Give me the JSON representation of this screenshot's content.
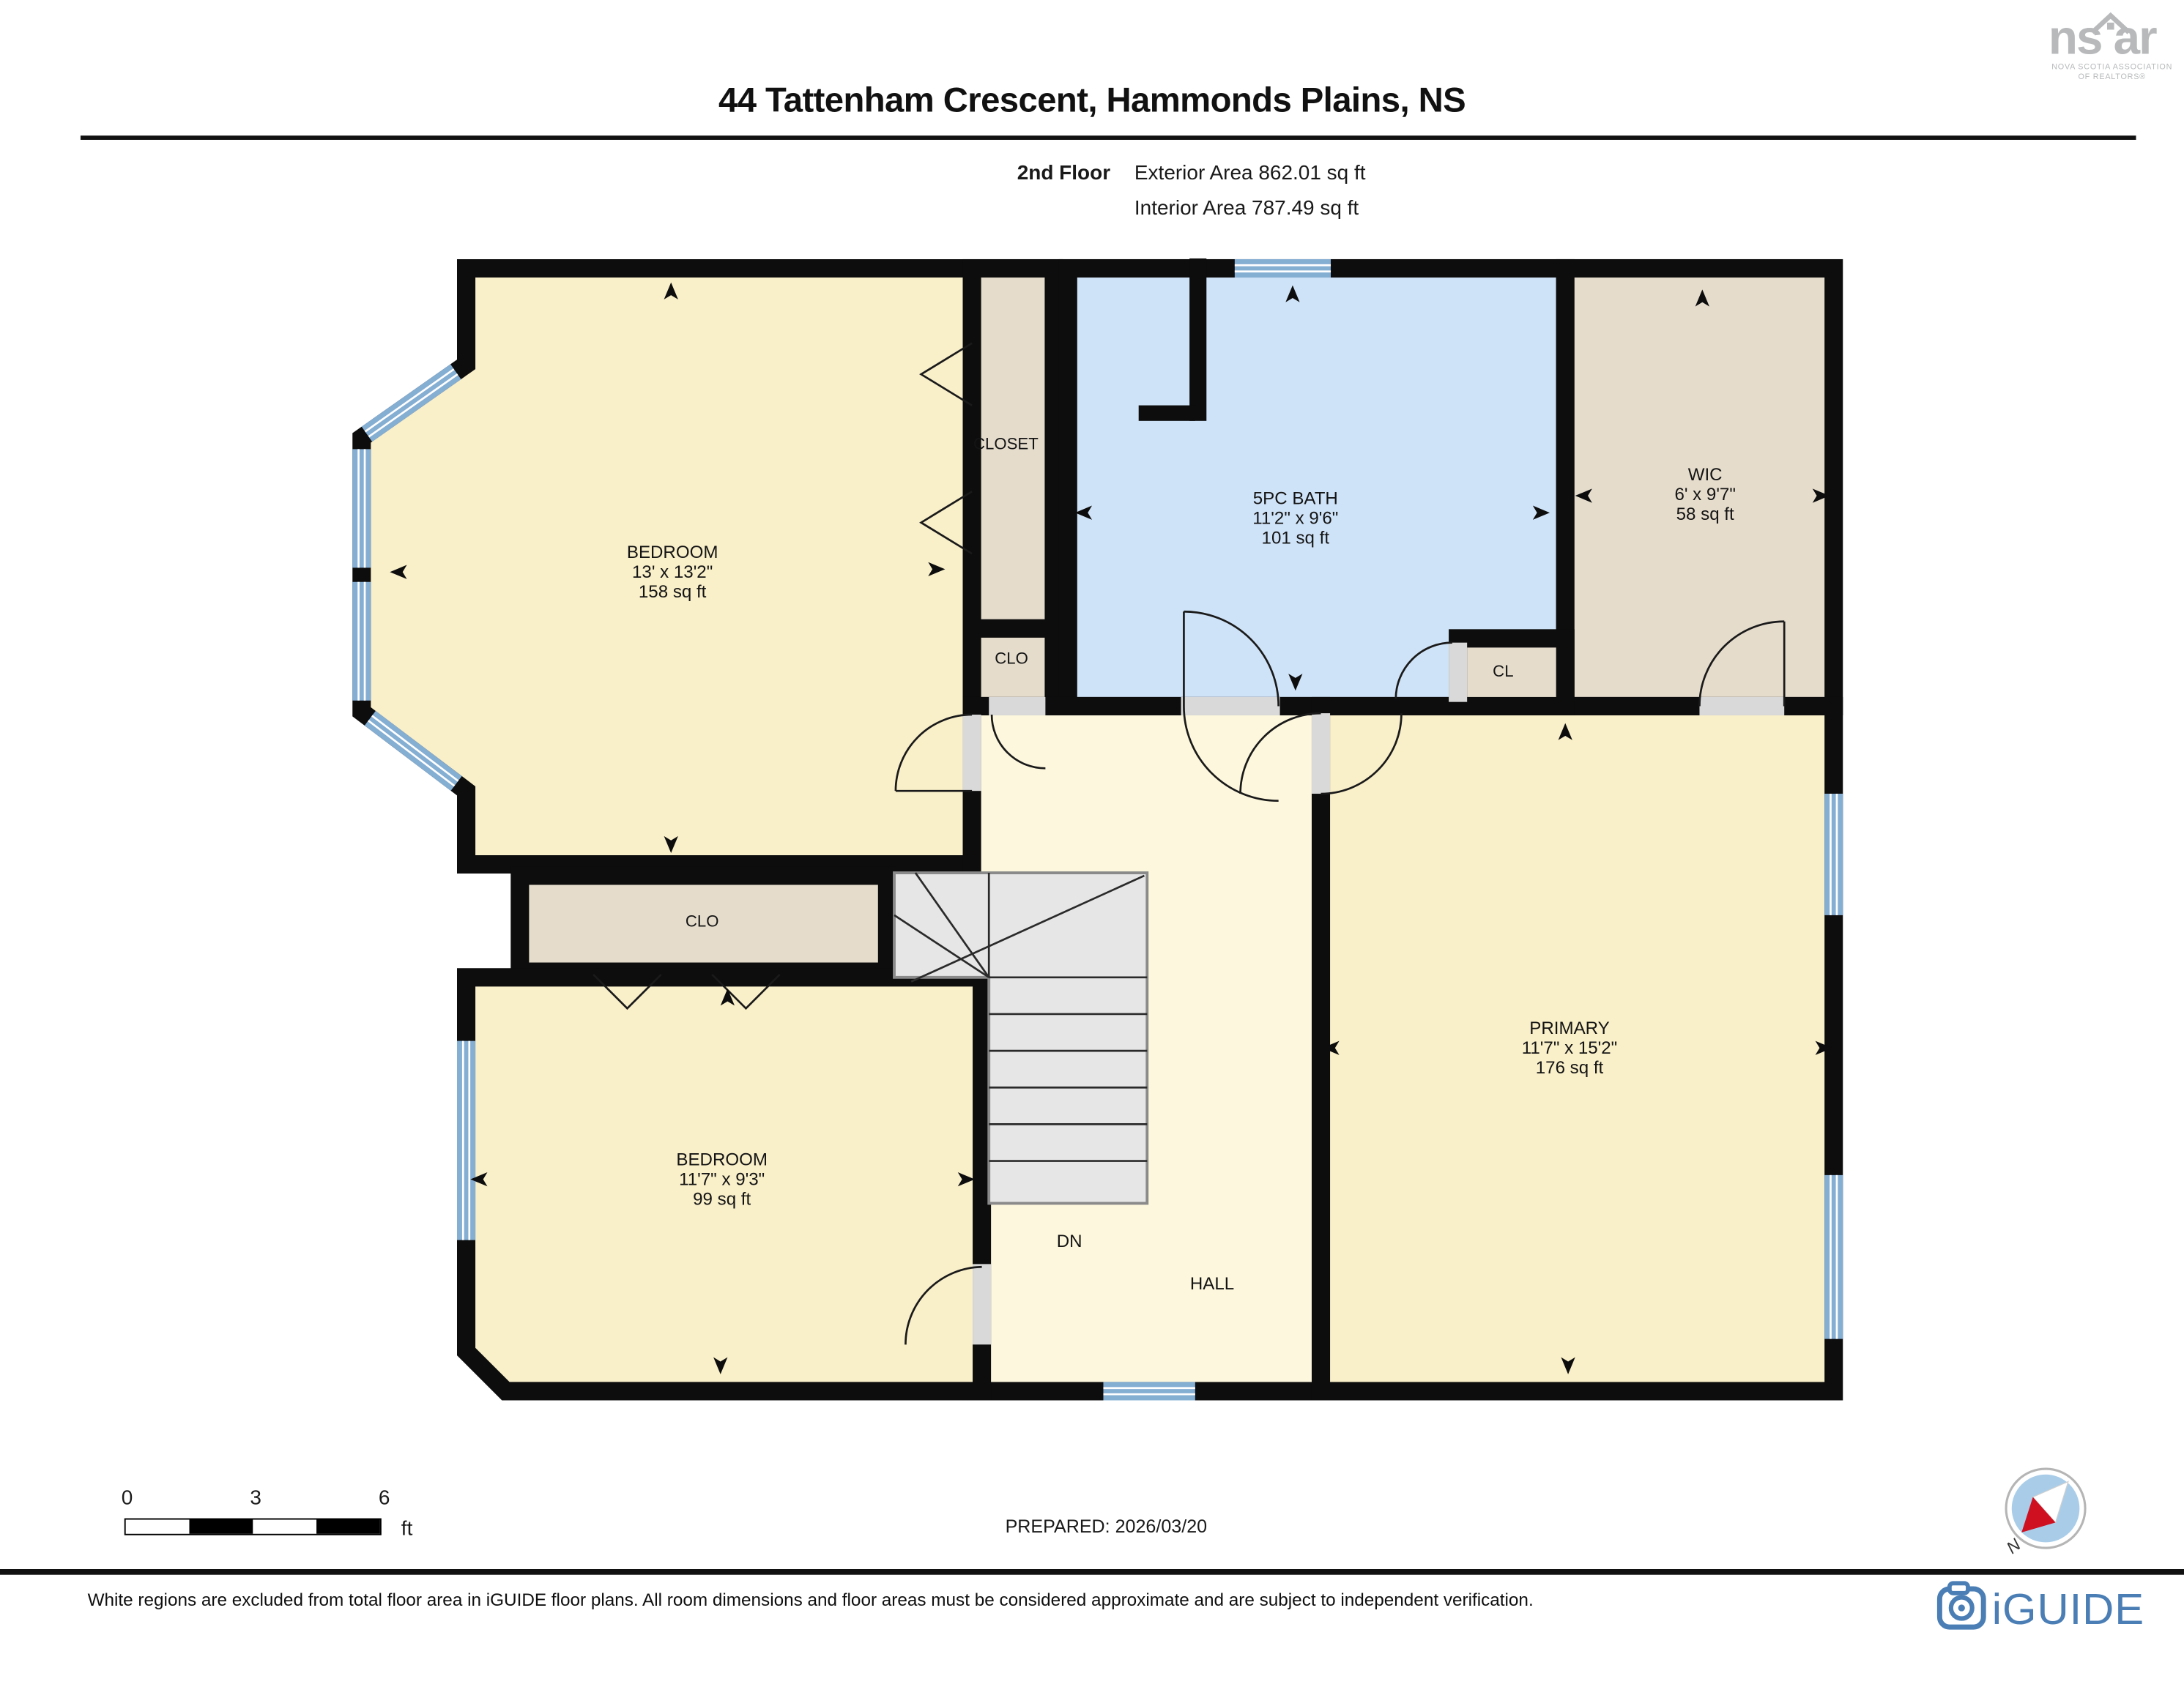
{
  "header": {
    "title": "44 Tattenham Crescent, Hammonds Plains, NS",
    "floor_label": "2nd Floor",
    "exterior_area": "Exterior Area 862.01 sq ft",
    "interior_area": "Interior Area 787.49 sq ft"
  },
  "rooms": {
    "bedroom_tl": {
      "name": "BEDROOM",
      "dims": "13' x 13'2\"",
      "area": "158 sq ft"
    },
    "closet_top": {
      "name": "CLOSET"
    },
    "clo_upper": {
      "name": "CLO"
    },
    "bath": {
      "name": "5PC BATH",
      "dims": "11'2\" x 9'6\"",
      "area": "101 sq ft"
    },
    "wic": {
      "name": "WIC",
      "dims": "6' x 9'7\"",
      "area": "58 sq ft"
    },
    "cl": {
      "name": "CL"
    },
    "clo_mid": {
      "name": "CLO"
    },
    "bedroom_bl": {
      "name": "BEDROOM",
      "dims": "11'7\" x 9'3\"",
      "area": "99 sq ft"
    },
    "primary": {
      "name": "PRIMARY",
      "dims": "11'7\" x 15'2\"",
      "area": "176 sq ft"
    },
    "hall": {
      "name": "HALL"
    },
    "stairs": {
      "label": "DN"
    }
  },
  "footer": {
    "scale_ticks": [
      "0",
      "3",
      "6"
    ],
    "scale_unit": "ft",
    "prepared": "PREPARED: 2026/03/20",
    "compass_label": "N",
    "disclaimer": "White regions are excluded from total floor area in iGUIDE floor plans. All room dimensions and floor areas must be considered approximate and are subject to independent verification."
  },
  "branding": {
    "nsar": {
      "word_left": "ns",
      "word_right": "ar",
      "caption_line1": "NOVA SCOTIA ASSOCIATION",
      "caption_line2": "OF REALTORS®"
    },
    "iguide": {
      "wordmark": "iGUIDE"
    }
  },
  "colors": {
    "room_yellow": "#f9efc9",
    "room_tan": "#e5dccc",
    "room_blue": "#cfe3f8",
    "hall_cream": "#fdf7dd",
    "window_blue": "#85aed3",
    "stairs_gray": "#e6e6e6",
    "wall_black": "#0d0d0d",
    "iguide_blue": "#4a7eb5",
    "nsar_gray": "#b7b9bb"
  }
}
